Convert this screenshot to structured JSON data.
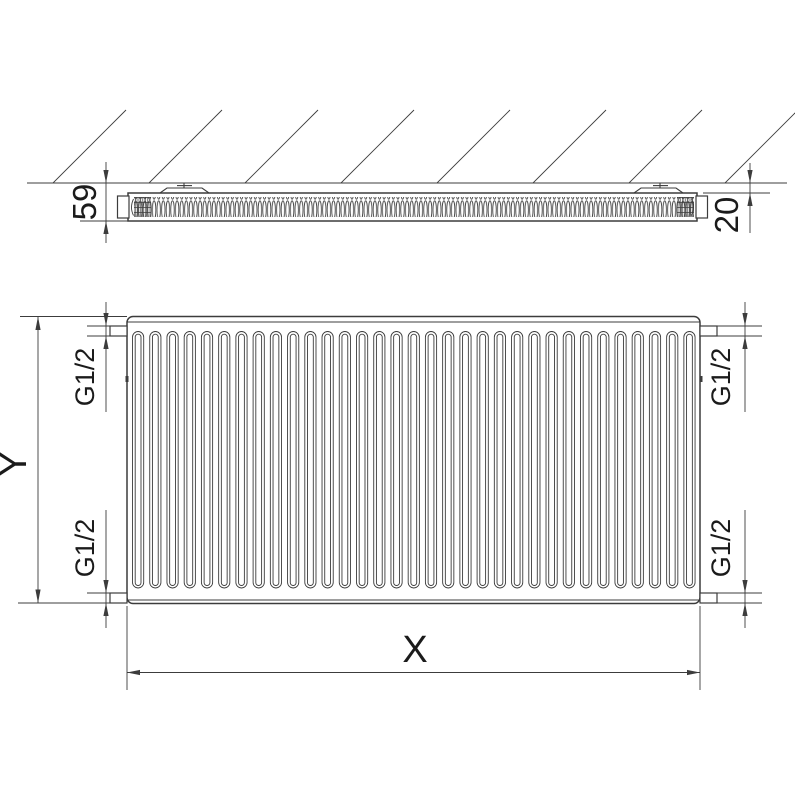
{
  "page": {
    "background": "#ffffff"
  },
  "drawing": {
    "type": "technical-drawing",
    "subject": "panel-radiator-type-11-dimension-drawing",
    "line_color": "#3c3c3c",
    "text_color": "#1b1b1b",
    "views": {
      "section_top": {
        "description": "horizontal section of radiator mounted at wall, wall shown hatched",
        "dimensions": {
          "depth": "59",
          "wall_distance": "20"
        }
      },
      "front": {
        "description": "front view of ribbed radiator panel with four G1/2 connections",
        "rib_count": 33,
        "dimensions": {
          "height": "Y",
          "width": "X",
          "connection_top_left": "G1/2",
          "connection_bottom_left": "G1/2",
          "connection_top_right": "G1/2",
          "connection_bottom_right": "G1/2"
        }
      }
    }
  }
}
